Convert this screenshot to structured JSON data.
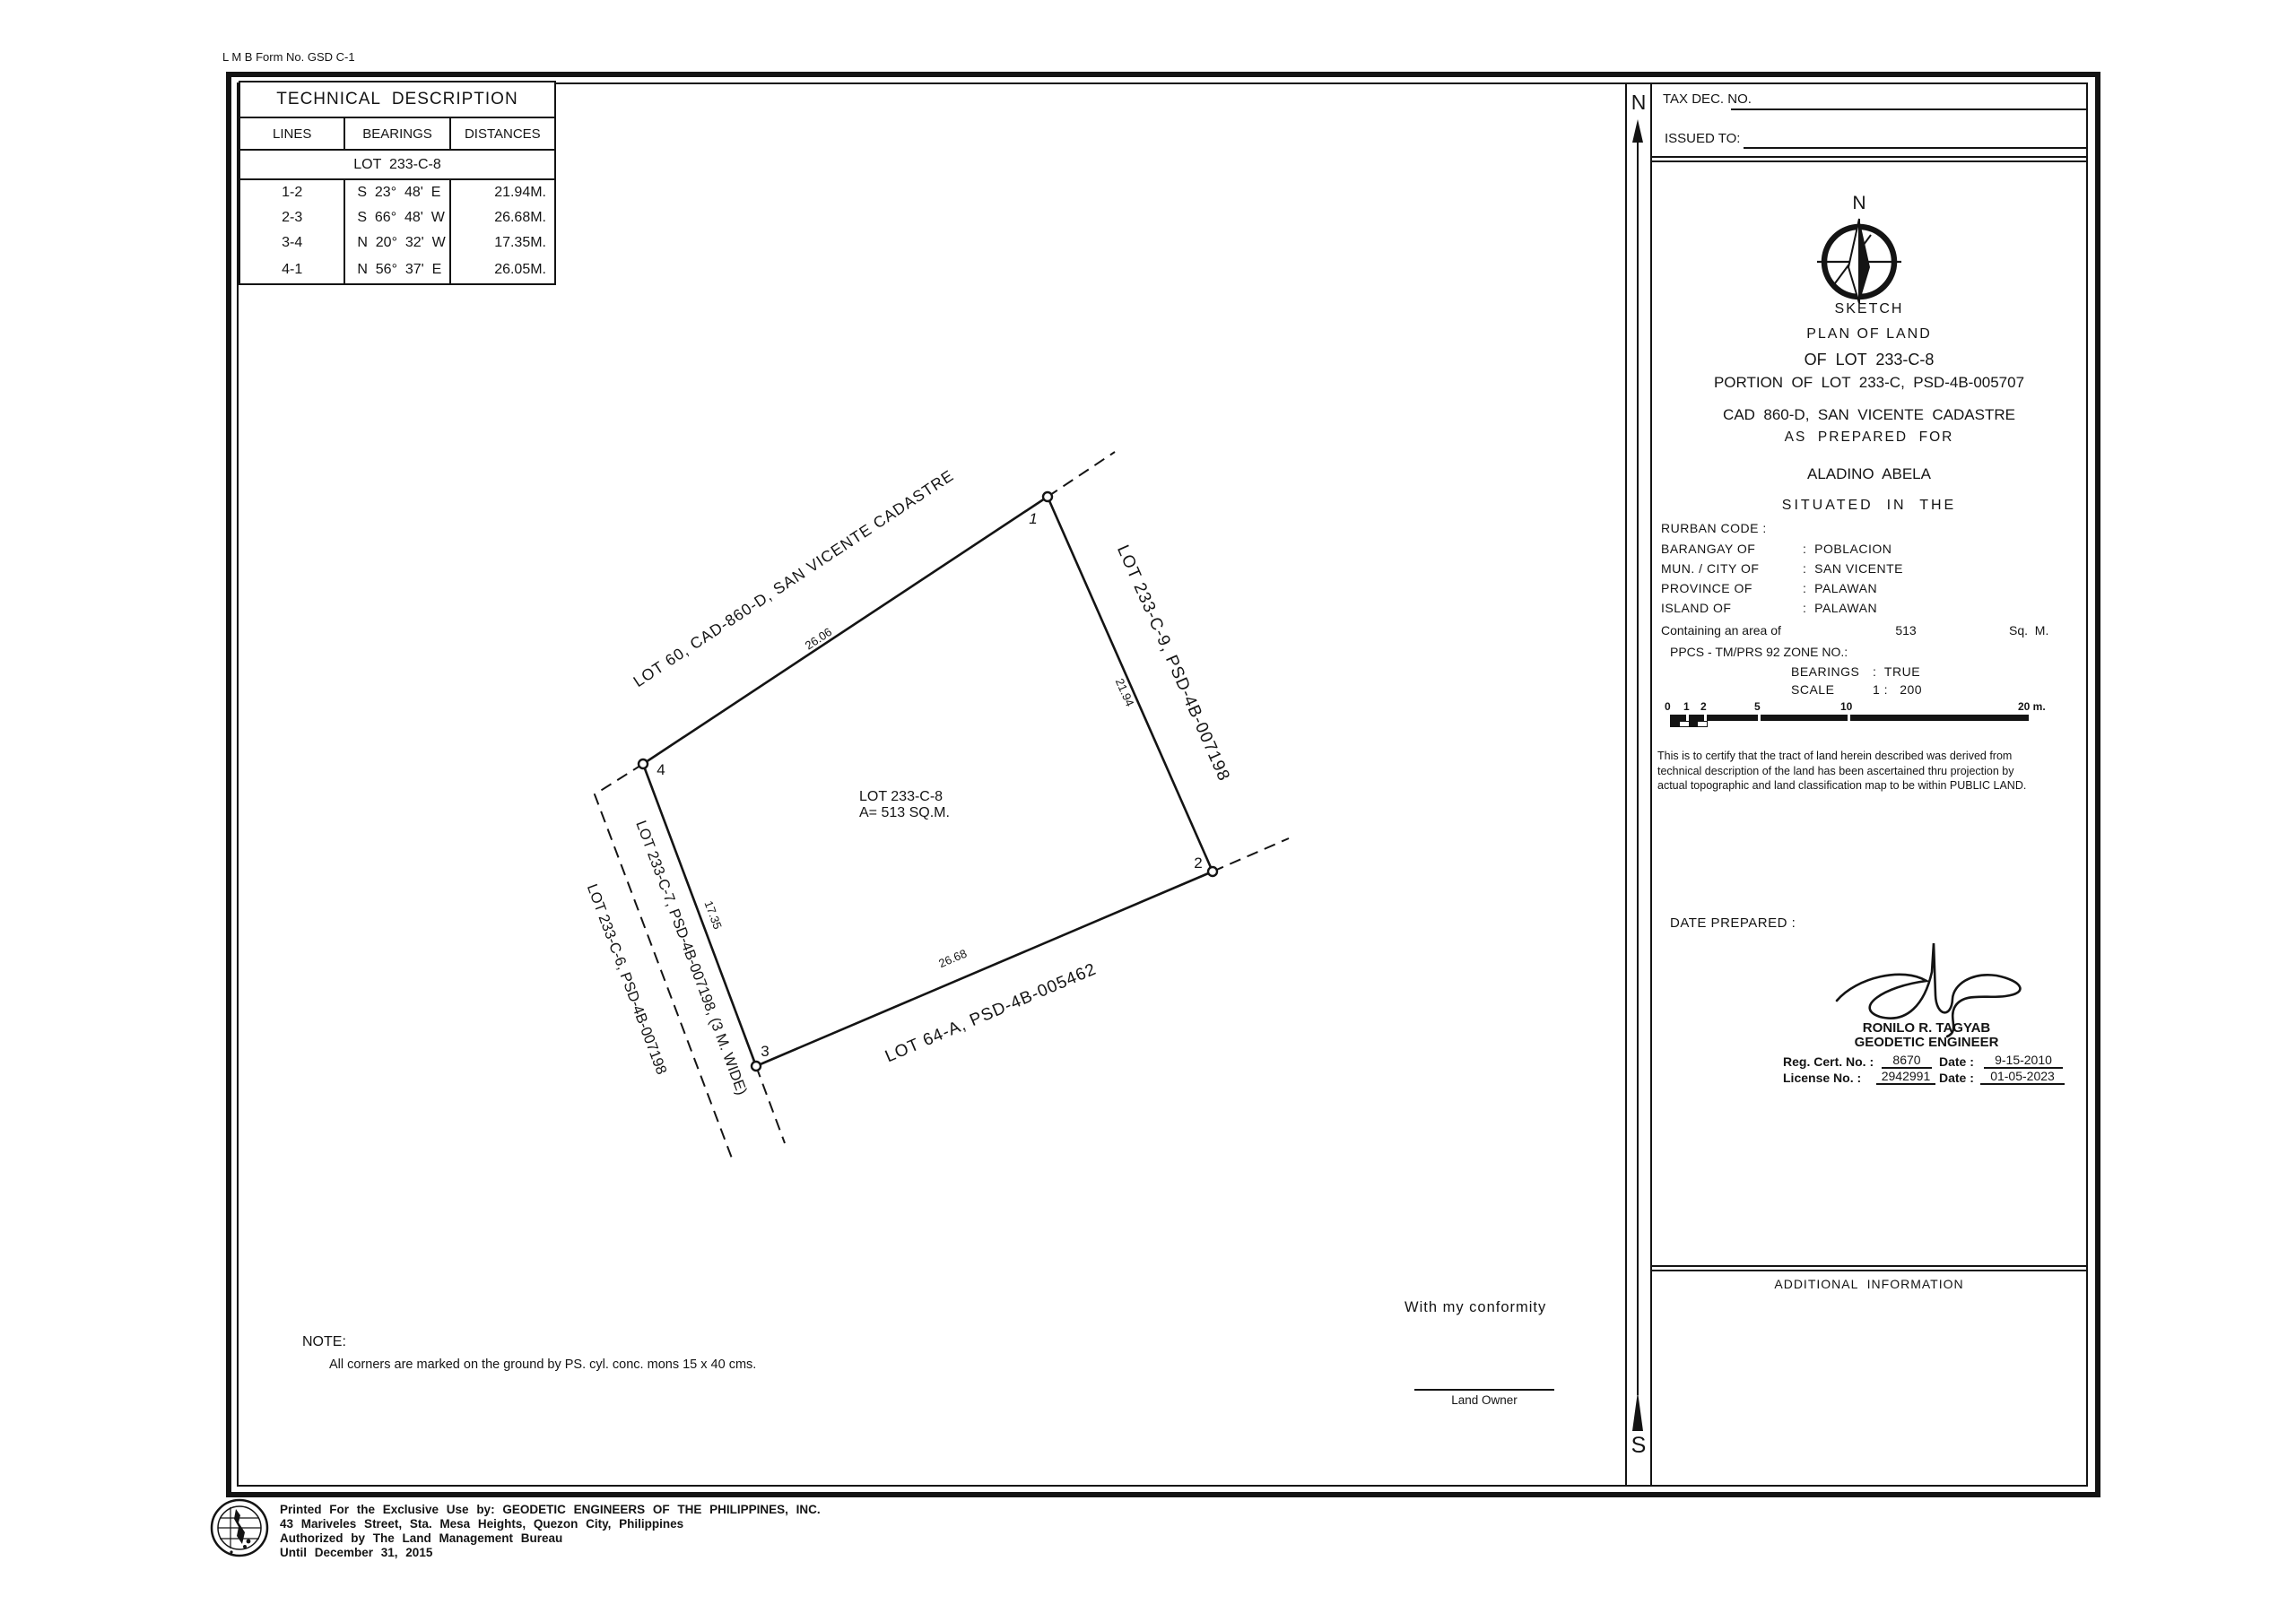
{
  "form_no": "L M B  Form No. GSD C-1",
  "tech_table": {
    "title": "TECHNICAL  DESCRIPTION",
    "col_lines": "LINES",
    "col_bearings": "BEARINGS",
    "col_distances": "DISTANCES",
    "lot_header": "LOT  233-C-8",
    "rows": [
      {
        "line": "1-2",
        "bearing": "S  23°  48'  E",
        "distance": "21.94M."
      },
      {
        "line": "2-3",
        "bearing": "S  66°  48'  W",
        "distance": "26.68M."
      },
      {
        "line": "3-4",
        "bearing": "N  20°  32'  W",
        "distance": "17.35M."
      },
      {
        "line": "4-1",
        "bearing": "N  56°  37'  E",
        "distance": "26.05M."
      }
    ]
  },
  "sketch": {
    "lot_label": "LOT 233-C-8",
    "area_label": "A= 513 SQ.M.",
    "corner_1": "1",
    "corner_2": "2",
    "corner_3": "3",
    "corner_4": "4",
    "dim_4_1": "26.06",
    "dim_1_2": "21.94",
    "dim_2_3": "26.68",
    "dim_3_4": "17.35",
    "adjacent_top": "LOT 60, CAD-860-D, SAN VICENTE CADASTRE",
    "adjacent_right": "LOT 233-C-9, PSD-4B-007198",
    "adjacent_bottom": "LOT 64-A, PSD-4B-005462",
    "adjacent_road": "LOT 233-C-7, PSD-4B-007198, (3 M. WIDE)",
    "adjacent_left": "LOT 233-C-6, PSD-4B-007198"
  },
  "note_heading": "NOTE:",
  "note_body": "All corners are marked on the ground by PS. cyl. conc. mons 15 x 40 cms.",
  "conformity_text": "With my conformity",
  "land_owner_label": "Land Owner",
  "meridian": {
    "north": "N",
    "south": "S"
  },
  "panel": {
    "tax_dec_label": "TAX DEC. NO.",
    "issued_to_label": "ISSUED TO:",
    "compass_n": "N",
    "title_lines": [
      "SKETCH",
      "PLAN OF LAND",
      "OF  LOT  233-C-8",
      "PORTION  OF  LOT  233-C,  PSD-4B-005707",
      "CAD  860-D,  SAN  VICENTE  CADASTRE",
      "AS  PREPARED  FOR",
      "ALADINO  ABELA",
      "SITUATED  IN  THE"
    ],
    "rurban_label": "RURBAN CODE :",
    "location_rows": [
      {
        "label": "BARANGAY OF",
        "value": ":  POBLACION"
      },
      {
        "label": "MUN. / CITY OF",
        "value": ":  SAN VICENTE"
      },
      {
        "label": "PROVINCE OF",
        "value": ":  PALAWAN"
      },
      {
        "label": "ISLAND OF",
        "value": ":  PALAWAN"
      }
    ],
    "area_label": "Containing an area of",
    "area_value": "513",
    "area_unit": "Sq.  M.",
    "ppcs_label": "PPCS - TM/PRS 92 ZONE NO.:",
    "bearings_label": "BEARINGS",
    "bearings_value": ":  TRUE",
    "scale_label": "SCALE",
    "scale_value": "1 :   200",
    "scale_bar": {
      "l0": "0",
      "l1": "1",
      "l2": "2",
      "l5": "5",
      "l10": "10",
      "l20": "20 m."
    },
    "certification": "This is to certify that the tract of land herein described was derived from technical description of the land has been ascertained thru projection by actual topographic and land classification map to be within PUBLIC LAND.",
    "date_prepared_label": "DATE PREPARED :",
    "engineer_name": "RONILO R. TAGYAB",
    "engineer_title": "GEODETIC ENGINEER",
    "reg_label": "Reg. Cert. No. :",
    "reg_value": "8670",
    "reg_date_label": "Date :",
    "reg_date": "9-15-2010",
    "lic_label": "License No. :",
    "lic_value": "2942991",
    "lic_date_label": "Date :",
    "lic_date": "01-05-2023",
    "additional_info": "ADDITIONAL  INFORMATION"
  },
  "footer": {
    "line1": "Printed For the Exclusive Use by: GEODETIC ENGINEERS OF THE PHILIPPINES, INC.",
    "line2": "43 Mariveles Street, Sta. Mesa Heights, Quezon City, Philippines",
    "line3": "Authorized by The Land Management Bureau",
    "line4": "Until December 31, 2015"
  }
}
